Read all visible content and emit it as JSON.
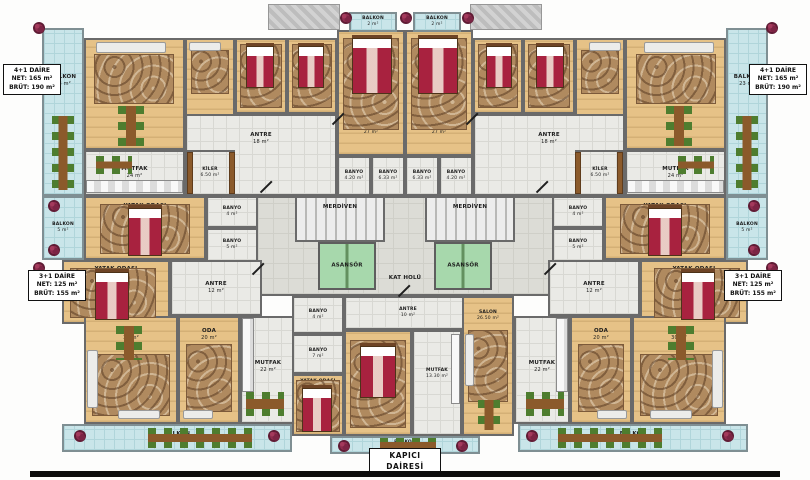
{
  "watermark": {
    "brand": "ResProperty",
    "subtitle": "зарубежная недвижимость"
  },
  "unit_labels": [
    {
      "id": "apt-4plus1-left",
      "x": 3,
      "y": 64,
      "w": 58,
      "big": false,
      "lines": [
        "4+1 DAİRE",
        "NET: 165 m²",
        "BRÜT: 190 m²"
      ]
    },
    {
      "id": "apt-4plus1-right",
      "x": 749,
      "y": 64,
      "w": 58,
      "big": false,
      "lines": [
        "4+1 DAİRE",
        "NET: 165 m²",
        "BRÜT: 190 m²"
      ]
    },
    {
      "id": "apt-3plus1-left",
      "x": 28,
      "y": 270,
      "w": 58,
      "big": false,
      "lines": [
        "3+1 DAİRE",
        "NET: 125 m²",
        "BRÜT: 155 m²"
      ]
    },
    {
      "id": "apt-3plus1-right",
      "x": 724,
      "y": 270,
      "w": 58,
      "big": false,
      "lines": [
        "3+1 DAİRE",
        "NET: 125 m²",
        "BRÜT: 155 m²"
      ]
    },
    {
      "id": "kapici-dairesi",
      "x": 369,
      "y": 448,
      "w": 72,
      "big": true,
      "lines": [
        "KAPICI",
        "DAİRESİ"
      ]
    }
  ],
  "rooms": [
    {
      "id": "kat-holu",
      "type": "tile2",
      "x": 241,
      "y": 196,
      "w": 328,
      "h": 100,
      "label": "KAT HOLÜ",
      "area": "",
      "labelBottom": 12
    },
    {
      "id": "merdiven-left",
      "type": "stairs",
      "x": 295,
      "y": 196,
      "w": 90,
      "h": 46,
      "label": "MERDİVEN",
      "area": "",
      "labelTop": 6
    },
    {
      "id": "merdiven-right",
      "type": "stairs",
      "x": 425,
      "y": 196,
      "w": 90,
      "h": 46,
      "label": "MERDİVEN",
      "area": "",
      "labelTop": 6
    },
    {
      "id": "asansor-left",
      "type": "elevator",
      "x": 318,
      "y": 242,
      "w": 58,
      "h": 48,
      "label": "ASANSÖR",
      "area": ""
    },
    {
      "id": "asansor-right",
      "type": "elevator",
      "x": 434,
      "y": 242,
      "w": 58,
      "h": 48,
      "label": "ASANSÖR",
      "area": ""
    },
    {
      "id": "balkon23-left",
      "type": "balcony",
      "x": 42,
      "y": 28,
      "w": 42,
      "h": 168,
      "label": "BALKON",
      "area": "23 m²",
      "labelTop": 44
    },
    {
      "id": "salon27-left",
      "type": "wood",
      "x": 84,
      "y": 38,
      "w": 101,
      "h": 112,
      "label": "SALON",
      "area": "27 m²"
    },
    {
      "id": "oda-left",
      "type": "wood",
      "x": 185,
      "y": 38,
      "w": 50,
      "h": 84,
      "label": "ODA",
      "area": "12.28 m²",
      "sm": true
    },
    {
      "id": "yatak14a-left",
      "type": "wood",
      "x": 235,
      "y": 38,
      "w": 52,
      "h": 76,
      "label": "YATAK ODASI",
      "area": "14 m²",
      "labelBottom": 6,
      "sm": true
    },
    {
      "id": "yatak14b-left",
      "type": "wood",
      "x": 287,
      "y": 38,
      "w": 50,
      "h": 76,
      "label": "YATAK ODASI",
      "area": "14 m²",
      "labelBottom": 6,
      "sm": true
    },
    {
      "id": "yatak27-left",
      "type": "wood",
      "x": 337,
      "y": 30,
      "w": 68,
      "h": 126,
      "label": "YATAK ODASI",
      "area": "27 m²",
      "labelBottom": 18,
      "sm": true
    },
    {
      "id": "balkon2-left",
      "type": "balcony",
      "x": 349,
      "y": 12,
      "w": 48,
      "h": 20,
      "label": "BALKON",
      "area": "2 m²",
      "labelTop": 2,
      "sm": true
    },
    {
      "id": "antre18-left",
      "type": "tile",
      "x": 185,
      "y": 114,
      "w": 152,
      "h": 82,
      "label": "ANTRE",
      "area": "18 m²",
      "labelTop": 16
    },
    {
      "id": "mutfak24-left",
      "type": "tile",
      "x": 84,
      "y": 150,
      "w": 101,
      "h": 46,
      "label": "MUTFAK",
      "area": "24 m²"
    },
    {
      "id": "kiler-left",
      "type": "tile",
      "x": 185,
      "y": 150,
      "w": 50,
      "h": 46,
      "label": "KİLER",
      "area": "6.50 m²",
      "sm": true
    },
    {
      "id": "banyo420-left",
      "type": "tile",
      "x": 337,
      "y": 156,
      "w": 34,
      "h": 40,
      "label": "BANYO",
      "area": "4.20 m²",
      "sm": true
    },
    {
      "id": "banyo633-left",
      "type": "tile",
      "x": 371,
      "y": 156,
      "w": 34,
      "h": 40,
      "label": "BANYO",
      "area": "6.33 m²",
      "sm": true
    },
    {
      "id": "balkon23-right",
      "type": "balcony",
      "x": 726,
      "y": 28,
      "w": 42,
      "h": 168,
      "label": "BALKON",
      "area": "23 m²",
      "labelTop": 44
    },
    {
      "id": "salon27-right",
      "type": "wood",
      "x": 625,
      "y": 38,
      "w": 101,
      "h": 112,
      "label": "SALON",
      "area": "27 m²"
    },
    {
      "id": "oda-right",
      "type": "wood",
      "x": 575,
      "y": 38,
      "w": 50,
      "h": 84,
      "label": "ODA",
      "area": "12.28 m²",
      "sm": true
    },
    {
      "id": "yatak14a-right",
      "type": "wood",
      "x": 523,
      "y": 38,
      "w": 52,
      "h": 76,
      "label": "YATAK ODASI",
      "area": "14 m²",
      "labelBottom": 6,
      "sm": true
    },
    {
      "id": "yatak14b-right",
      "type": "wood",
      "x": 473,
      "y": 38,
      "w": 50,
      "h": 76,
      "label": "YATAK ODASI",
      "area": "14 m²",
      "labelBottom": 6,
      "sm": true
    },
    {
      "id": "yatak27-right",
      "type": "wood",
      "x": 405,
      "y": 30,
      "w": 68,
      "h": 126,
      "label": "YATAK ODASI",
      "area": "27 m²",
      "labelBottom": 18,
      "sm": true
    },
    {
      "id": "balkon2-right",
      "type": "balcony",
      "x": 413,
      "y": 12,
      "w": 48,
      "h": 20,
      "label": "BALKON",
      "area": "2 m²",
      "labelTop": 2,
      "sm": true
    },
    {
      "id": "antre18-right",
      "type": "tile",
      "x": 473,
      "y": 114,
      "w": 152,
      "h": 82,
      "label": "ANTRE",
      "area": "18 m²",
      "labelTop": 16
    },
    {
      "id": "mutfak24-right",
      "type": "tile",
      "x": 625,
      "y": 150,
      "w": 101,
      "h": 46,
      "label": "MUTFAK",
      "area": "24 m²"
    },
    {
      "id": "kiler-right",
      "type": "tile",
      "x": 575,
      "y": 150,
      "w": 50,
      "h": 46,
      "label": "KİLER",
      "area": "6.50 m²",
      "sm": true
    },
    {
      "id": "banyo420-right",
      "type": "tile",
      "x": 439,
      "y": 156,
      "w": 34,
      "h": 40,
      "label": "BANYO",
      "area": "4.20 m²",
      "sm": true
    },
    {
      "id": "banyo633-right",
      "type": "tile",
      "x": 405,
      "y": 156,
      "w": 34,
      "h": 40,
      "label": "BANYO",
      "area": "6.33 m²",
      "sm": true
    },
    {
      "id": "balkon5-left",
      "type": "balcony",
      "x": 42,
      "y": 196,
      "w": 42,
      "h": 64,
      "label": "BALKON",
      "area": "5 m²",
      "sm": true
    },
    {
      "id": "yatak15-left",
      "type": "wood",
      "x": 84,
      "y": 196,
      "w": 122,
      "h": 64,
      "label": "YATAK ODASI",
      "area": "15 m²",
      "labelTop": 5
    },
    {
      "id": "banyo4-left",
      "type": "tile",
      "x": 206,
      "y": 196,
      "w": 52,
      "h": 32,
      "label": "BANYO",
      "area": "4 m²",
      "sm": true
    },
    {
      "id": "banyo5-left",
      "type": "tile",
      "x": 206,
      "y": 228,
      "w": 52,
      "h": 34,
      "label": "BANYO",
      "area": "5 m²",
      "sm": true
    },
    {
      "id": "yatak13-left",
      "type": "wood",
      "x": 62,
      "y": 260,
      "w": 108,
      "h": 64,
      "label": "YATAK ODASI",
      "area": "13 m²",
      "labelTop": 4
    },
    {
      "id": "antre12-left",
      "type": "tile",
      "x": 170,
      "y": 260,
      "w": 92,
      "h": 56,
      "label": "ANTRE",
      "area": "12 m²"
    },
    {
      "id": "balkon5-right",
      "type": "balcony",
      "x": 726,
      "y": 196,
      "w": 42,
      "h": 64,
      "label": "BALKON",
      "area": "5 m²",
      "sm": true
    },
    {
      "id": "yatak15-right",
      "type": "wood",
      "x": 604,
      "y": 196,
      "w": 122,
      "h": 64,
      "label": "YATAK ODASI",
      "area": "15 m²",
      "labelTop": 5
    },
    {
      "id": "banyo4-right",
      "type": "tile",
      "x": 552,
      "y": 196,
      "w": 52,
      "h": 32,
      "label": "BANYO",
      "area": "4 m²",
      "sm": true
    },
    {
      "id": "banyo5-right",
      "type": "tile",
      "x": 552,
      "y": 228,
      "w": 52,
      "h": 34,
      "label": "BANYO",
      "area": "5 m²",
      "sm": true
    },
    {
      "id": "yatak13-right",
      "type": "wood",
      "x": 640,
      "y": 260,
      "w": 108,
      "h": 64,
      "label": "YATAK ODASI",
      "area": "13 m²",
      "labelTop": 4
    },
    {
      "id": "antre12-right",
      "type": "tile",
      "x": 548,
      "y": 260,
      "w": 92,
      "h": 56,
      "label": "ANTRE",
      "area": "12 m²"
    },
    {
      "id": "salon30-left",
      "type": "wood",
      "x": 84,
      "y": 316,
      "w": 94,
      "h": 108,
      "label": "SALON",
      "area": "30 m²",
      "labelTop": 10
    },
    {
      "id": "oda20-left",
      "type": "wood",
      "x": 178,
      "y": 316,
      "w": 62,
      "h": 108,
      "label": "ODA",
      "area": "20 m²",
      "labelTop": 10
    },
    {
      "id": "mutfak22-left",
      "type": "tile",
      "x": 240,
      "y": 316,
      "w": 56,
      "h": 108,
      "label": "MUTFAK",
      "area": "22 m²",
      "labelTop": 42
    },
    {
      "id": "balkon27-left",
      "type": "balcony",
      "x": 62,
      "y": 424,
      "w": 230,
      "h": 28,
      "label": "BALKON",
      "area": "27 m²"
    },
    {
      "id": "salon30-right",
      "type": "wood",
      "x": 632,
      "y": 316,
      "w": 94,
      "h": 108,
      "label": "SALON",
      "area": "30 m²",
      "labelTop": 10
    },
    {
      "id": "oda20-right",
      "type": "wood",
      "x": 570,
      "y": 316,
      "w": 62,
      "h": 108,
      "label": "ODA",
      "area": "20 m²",
      "labelTop": 10
    },
    {
      "id": "mutfak22-right",
      "type": "tile",
      "x": 514,
      "y": 316,
      "w": 56,
      "h": 108,
      "label": "MUTFAK",
      "area": "22 m²",
      "labelTop": 42
    },
    {
      "id": "balkon27-right",
      "type": "balcony",
      "x": 518,
      "y": 424,
      "w": 230,
      "h": 28,
      "label": "BALKON",
      "area": "27 m²"
    },
    {
      "id": "antre10-kapici",
      "type": "tile",
      "x": 344,
      "y": 296,
      "w": 128,
      "h": 34,
      "label": "ANTRE",
      "area": "10 m²",
      "sm": true
    },
    {
      "id": "banyo4-kapici",
      "type": "tile",
      "x": 292,
      "y": 296,
      "w": 52,
      "h": 38,
      "label": "BANYO",
      "area": "4 m²",
      "sm": true
    },
    {
      "id": "banyo7-kapici",
      "type": "tile",
      "x": 292,
      "y": 334,
      "w": 52,
      "h": 40,
      "label": "BANYO",
      "area": "7 m²",
      "sm": true
    },
    {
      "id": "yatak14-kapici",
      "type": "wood",
      "x": 292,
      "y": 374,
      "w": 52,
      "h": 62,
      "label": "YATAK ODASI",
      "area": "14 m²",
      "labelTop": 3,
      "sm": true
    },
    {
      "id": "yatak1350-kapici",
      "type": "wood",
      "x": 344,
      "y": 330,
      "w": 68,
      "h": 106,
      "label": "YATAK ODASI",
      "area": "13.50 m²",
      "labelBottom": 14,
      "sm": true
    },
    {
      "id": "mutfak1330-kapici",
      "type": "tile",
      "x": 412,
      "y": 330,
      "w": 50,
      "h": 106,
      "label": "MUTFAK",
      "area": "13.30 m²",
      "labelTop": 36,
      "sm": true
    },
    {
      "id": "salon2650-kapici",
      "type": "wood",
      "x": 462,
      "y": 296,
      "w": 52,
      "h": 140,
      "label": "SALON",
      "area": "26.50 m²",
      "labelTop": 12,
      "sm": true
    },
    {
      "id": "balkon7-kapici",
      "type": "balcony",
      "x": 330,
      "y": 436,
      "w": 150,
      "h": 18,
      "label": "BALKON",
      "area": "7 m²",
      "labelTop": 2,
      "sm": true
    }
  ],
  "furniture": [
    [
      "hatch",
      268,
      4,
      72,
      26
    ],
    [
      "hatch",
      470,
      4,
      72,
      26
    ],
    [
      "carpet",
      94,
      54,
      80,
      50
    ],
    [
      "carpet",
      636,
      54,
      80,
      50
    ],
    [
      "carpet",
      191,
      50,
      38,
      44
    ],
    [
      "carpet",
      581,
      50,
      38,
      44
    ],
    [
      "carpet",
      240,
      44,
      42,
      64
    ],
    [
      "carpet",
      528,
      44,
      42,
      64
    ],
    [
      "carpet",
      292,
      44,
      40,
      64
    ],
    [
      "carpet",
      478,
      44,
      40,
      64
    ],
    [
      "carpet",
      343,
      38,
      56,
      92
    ],
    [
      "carpet",
      411,
      38,
      56,
      92
    ],
    [
      "carpet",
      100,
      204,
      90,
      50
    ],
    [
      "carpet",
      620,
      204,
      90,
      50
    ],
    [
      "carpet",
      70,
      268,
      86,
      50
    ],
    [
      "carpet",
      654,
      268,
      86,
      50
    ],
    [
      "carpet",
      92,
      354,
      78,
      62
    ],
    [
      "carpet",
      640,
      354,
      78,
      62
    ],
    [
      "carpet",
      186,
      344,
      46,
      68
    ],
    [
      "carpet",
      578,
      344,
      46,
      68
    ],
    [
      "carpet",
      296,
      380,
      44,
      52
    ],
    [
      "carpet",
      350,
      340,
      56,
      88
    ],
    [
      "carpet",
      468,
      330,
      40,
      72
    ],
    [
      "bed",
      246,
      46,
      28,
      42
    ],
    [
      "bed",
      298,
      46,
      26,
      42
    ],
    [
      "bed",
      352,
      38,
      40,
      56
    ],
    [
      "bed",
      128,
      208,
      34,
      48
    ],
    [
      "bed",
      95,
      272,
      34,
      48
    ],
    [
      "bed",
      302,
      388,
      30,
      44
    ],
    [
      "bed",
      360,
      346,
      36,
      52
    ],
    [
      "bed",
      536,
      46,
      28,
      42
    ],
    [
      "bed",
      486,
      46,
      26,
      42
    ],
    [
      "bed",
      418,
      38,
      40,
      56
    ],
    [
      "bed",
      648,
      208,
      34,
      48
    ],
    [
      "bed",
      681,
      272,
      34,
      48
    ],
    [
      "dining-v",
      52,
      116,
      22,
      74
    ],
    [
      "dining-v",
      736,
      116,
      22,
      74
    ],
    [
      "dining-v",
      118,
      106,
      26,
      40
    ],
    [
      "dining-v",
      666,
      106,
      26,
      40
    ],
    [
      "dining-v",
      116,
      326,
      26,
      34
    ],
    [
      "dining-v",
      668,
      326,
      26,
      34
    ],
    [
      "dining-v",
      478,
      400,
      22,
      30
    ],
    [
      "dining-h",
      96,
      156,
      36,
      18
    ],
    [
      "dining-h",
      678,
      156,
      36,
      18
    ],
    [
      "dining-h",
      246,
      392,
      38,
      24
    ],
    [
      "dining-h",
      526,
      392,
      38,
      24
    ],
    [
      "dining-h",
      148,
      428,
      104,
      20
    ],
    [
      "dining-h",
      558,
      428,
      104,
      20
    ],
    [
      "dining-h",
      380,
      438,
      56,
      14
    ],
    [
      "sofa",
      96,
      42,
      70,
      11
    ],
    [
      "sofa",
      644,
      42,
      70,
      11
    ],
    [
      "sofa",
      189,
      42,
      32,
      9
    ],
    [
      "sofa",
      589,
      42,
      32,
      9
    ],
    [
      "sofa",
      87,
      350,
      11,
      58
    ],
    [
      "sofa",
      712,
      350,
      11,
      58
    ],
    [
      "sofa",
      118,
      410,
      42,
      9
    ],
    [
      "sofa",
      650,
      410,
      42,
      9
    ],
    [
      "sofa",
      183,
      410,
      30,
      9
    ],
    [
      "sofa",
      597,
      410,
      30,
      9
    ],
    [
      "sofa",
      465,
      334,
      9,
      52
    ],
    [
      "counter",
      86,
      180,
      97,
      13
    ],
    [
      "counter",
      627,
      180,
      97,
      13
    ],
    [
      "counter",
      242,
      318,
      12,
      74
    ],
    [
      "counter",
      556,
      318,
      12,
      74
    ],
    [
      "counter",
      451,
      334,
      9,
      70
    ],
    [
      "shelf",
      187,
      152,
      6,
      42
    ],
    [
      "shelf",
      229,
      152,
      6,
      42
    ],
    [
      "shelf",
      617,
      152,
      6,
      42
    ],
    [
      "shelf",
      575,
      152,
      6,
      42
    ]
  ],
  "plants": [
    [
      33,
      22
    ],
    [
      766,
      22
    ],
    [
      340,
      12
    ],
    [
      400,
      12
    ],
    [
      462,
      12
    ],
    [
      48,
      200
    ],
    [
      48,
      244
    ],
    [
      748,
      200
    ],
    [
      748,
      244
    ],
    [
      33,
      262
    ],
    [
      766,
      262
    ],
    [
      74,
      430
    ],
    [
      268,
      430
    ],
    [
      526,
      430
    ],
    [
      722,
      430
    ],
    [
      338,
      440
    ],
    [
      456,
      440
    ]
  ],
  "doors": [
    [
      258,
      186
    ],
    [
      534,
      186
    ],
    [
      250,
      268
    ],
    [
      542,
      268
    ],
    [
      396,
      290
    ],
    [
      330,
      118
    ],
    [
      464,
      118
    ]
  ],
  "colors": {
    "wood": "#e6c287",
    "tile": "#eaeae6",
    "balcony": "#c9e5e9",
    "elevator": "#a7d8ac",
    "bed": "#a8223f",
    "carpet": "#b08a5f",
    "chair_green": "#4e7d2f",
    "table_brown": "#8b5a2b",
    "wall": "#6a6a6a",
    "plant": "#8e2c4e",
    "bottom_bar": "#0c0c0c"
  }
}
